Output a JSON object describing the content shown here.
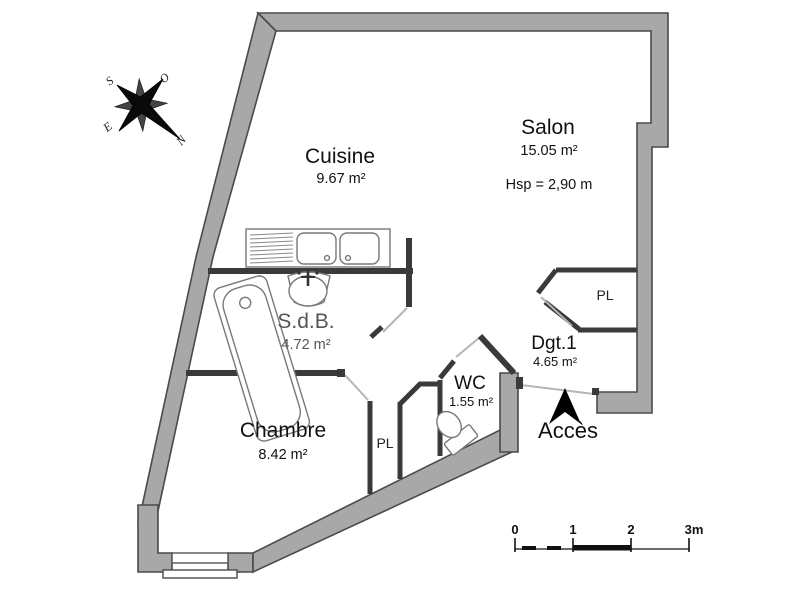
{
  "rooms": [
    {
      "id": "cuisine",
      "name": "Cuisine",
      "area": "9.67 m²"
    },
    {
      "id": "salon",
      "name": "Salon",
      "area": "15.05 m²",
      "note": "Hsp =  2,90 m"
    },
    {
      "id": "sdb",
      "name": "S.d.B.",
      "area": "4.72 m²"
    },
    {
      "id": "chambre",
      "name": "Chambre",
      "area": "8.42 m²"
    },
    {
      "id": "wc",
      "name": "WC",
      "area": "1.55 m²"
    },
    {
      "id": "dgt",
      "name": "Dgt.1",
      "area": "4.65 m²"
    }
  ],
  "closets": {
    "salon_pl": "PL",
    "chambre_pl": "PL"
  },
  "entrance": {
    "label": "Accès"
  },
  "compass": {
    "north": "N",
    "south": "S",
    "east": "E",
    "west": "O"
  },
  "scale_bar": {
    "ticks": [
      "0",
      "1",
      "2",
      "3m"
    ]
  },
  "colors": {
    "wall_fill": "#a8a8a8",
    "wall_stroke": "#4a4a4a",
    "interior_wall": "#3a3a3a",
    "text": "#111111",
    "muted_text": "#555555"
  }
}
